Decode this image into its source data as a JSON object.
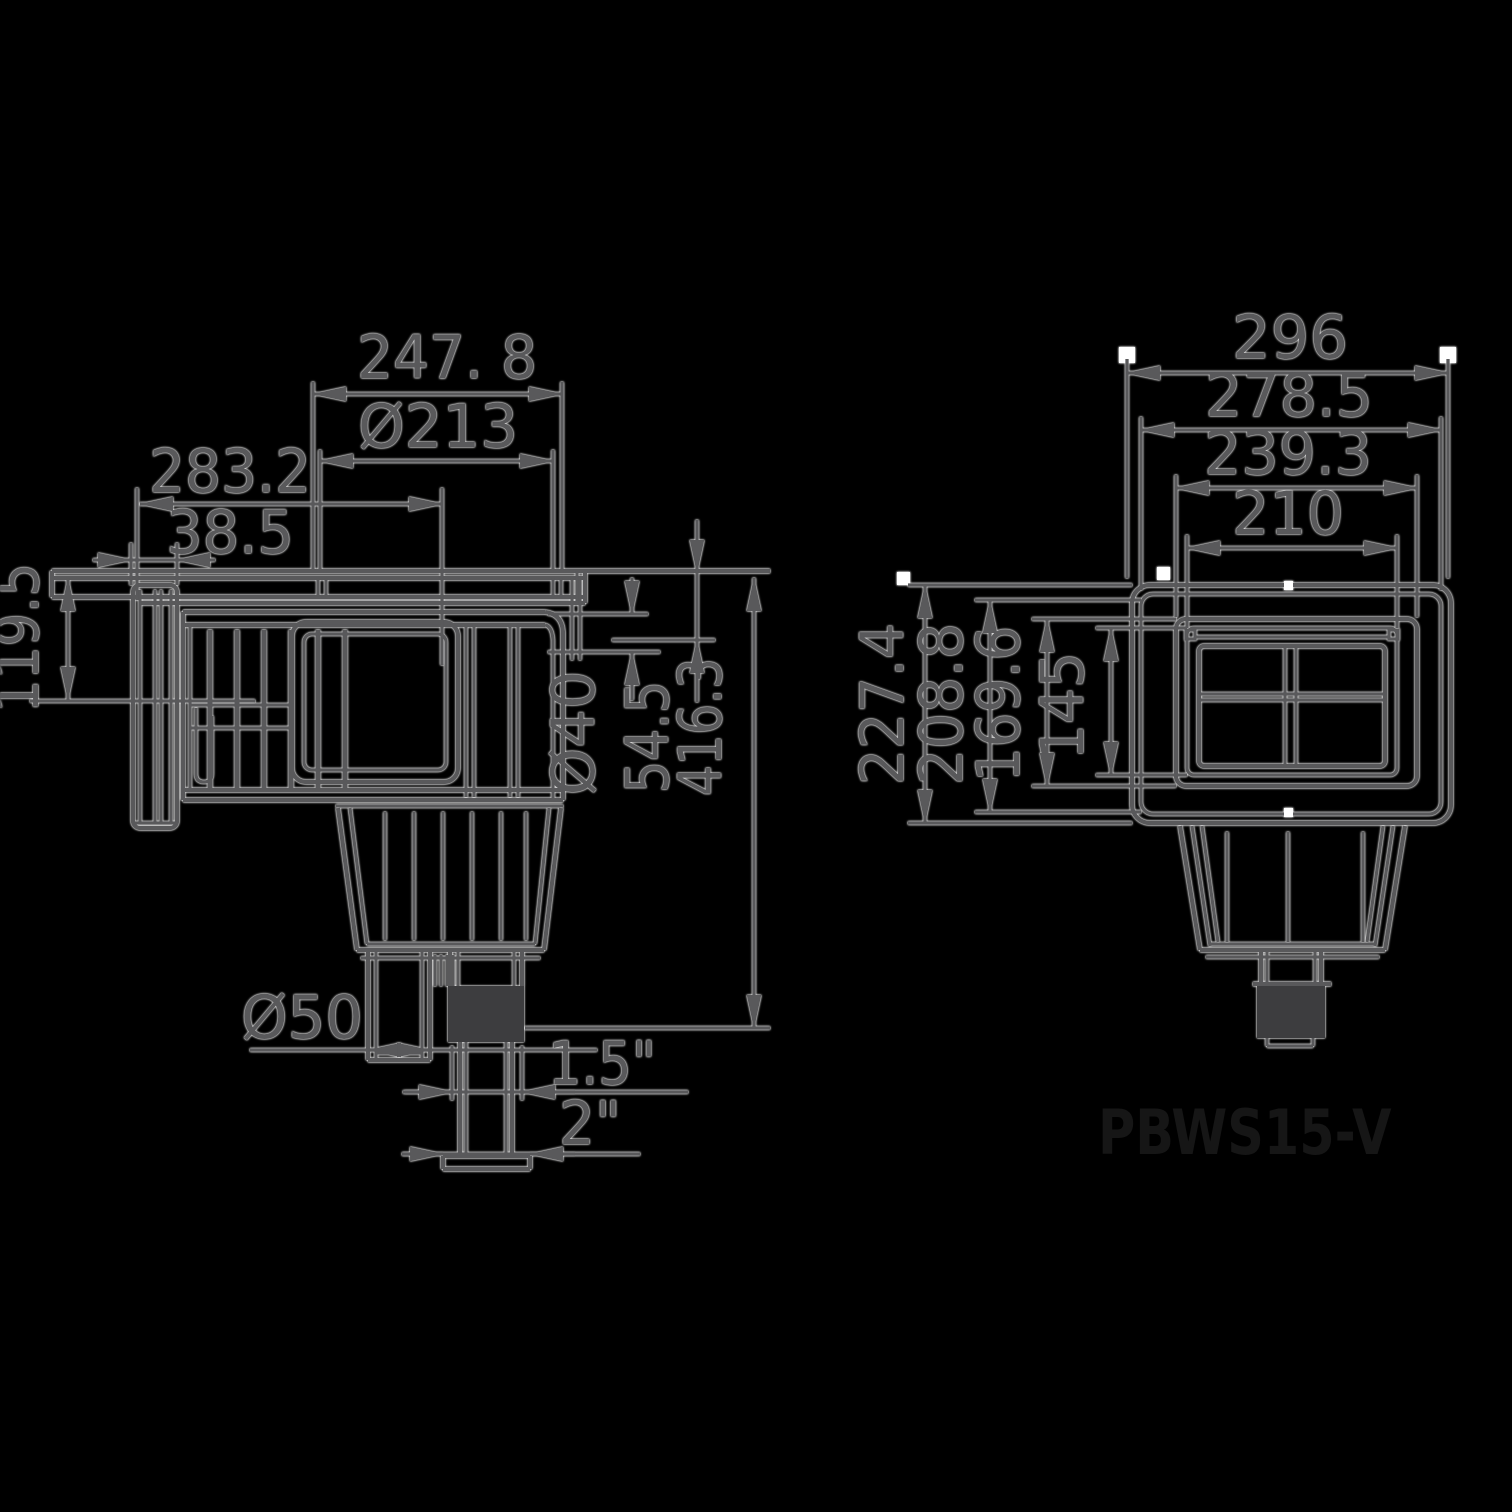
{
  "left_view": {
    "top_width": "247. 8",
    "lid_diameter": "Ø213",
    "body_depth": "283.2",
    "wall_thickness": "38.5",
    "flange_height": "119.5",
    "return_port_diameter": "Ø40",
    "top_to_port": "54.5",
    "overall_height": "416.3",
    "outlet_diameter": "Ø50",
    "outlet_thread_small": "1.5\"",
    "outlet_thread_large": "2\""
  },
  "right_view": {
    "overall_width": "296",
    "frame_width": "278.5",
    "faceplate_width": "239.3",
    "opening_width": "210",
    "overall_height": "227.4",
    "frame_height": "208.8",
    "faceplate_height": "169.6",
    "opening_height": "145"
  },
  "model_number": "PBWS15-V",
  "colors": {
    "bg": "#000000",
    "line": "#59595b",
    "model": "#161616"
  }
}
